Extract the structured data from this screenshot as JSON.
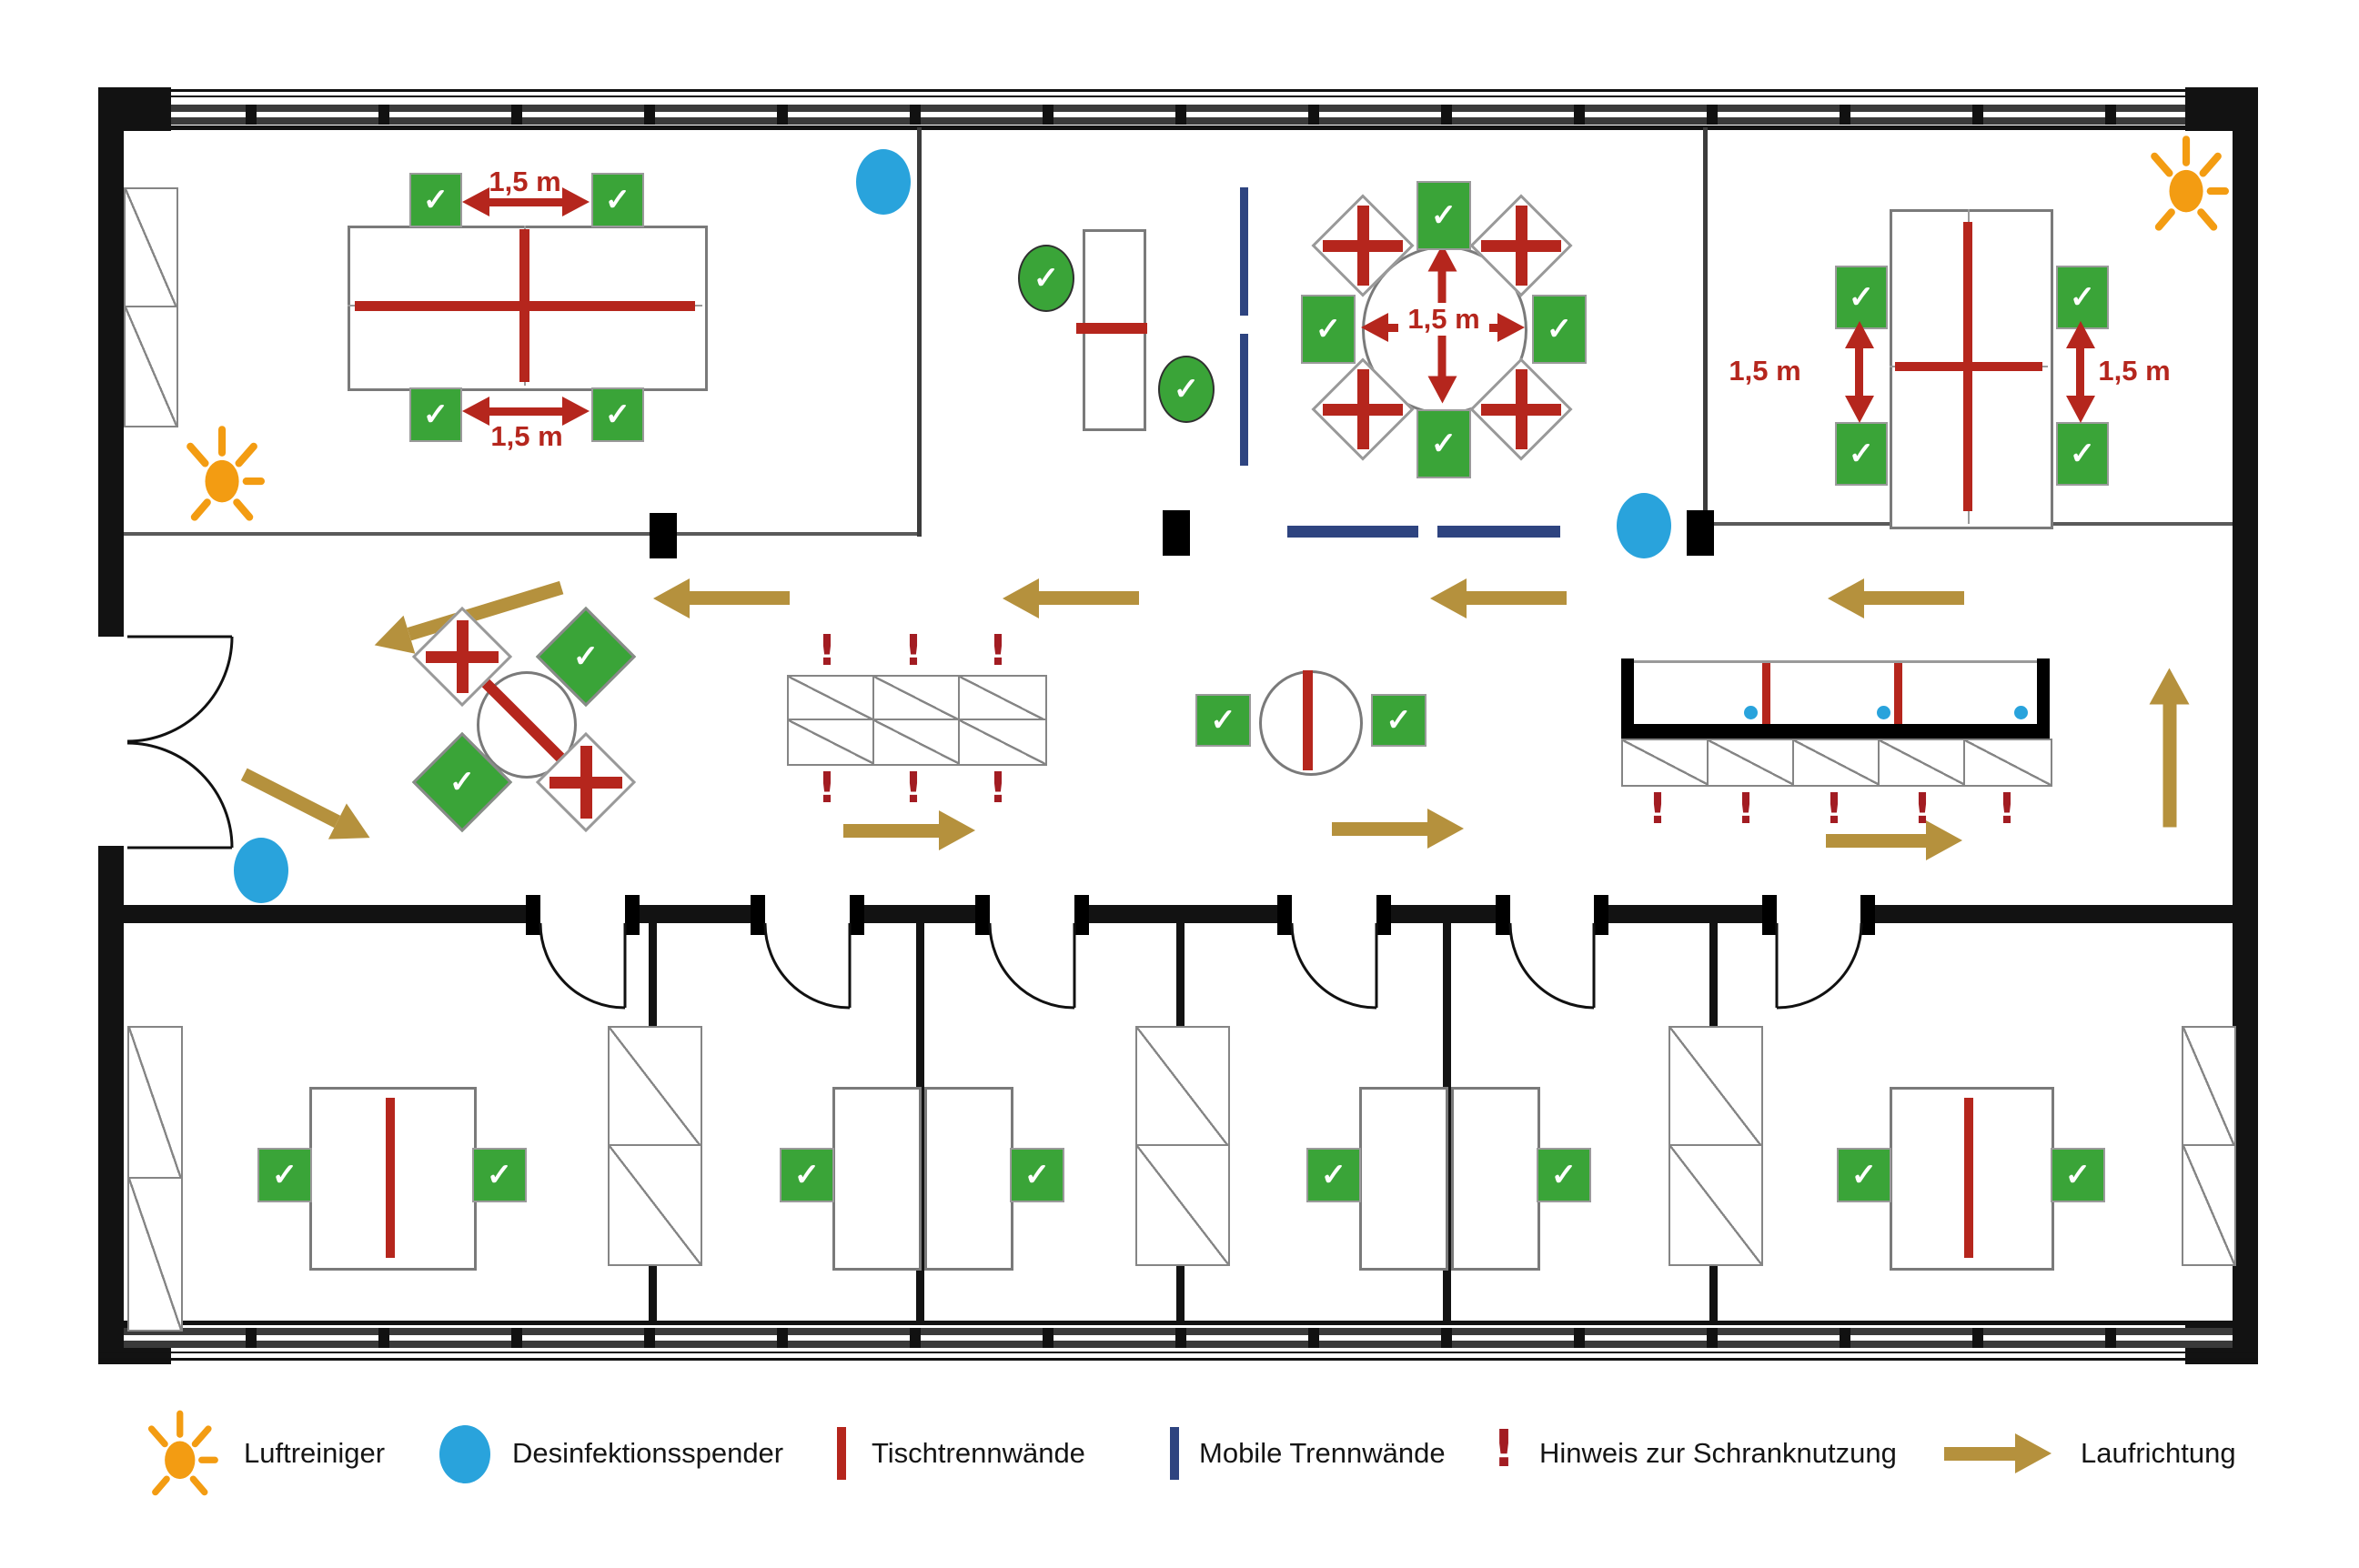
{
  "legend": {
    "items": [
      {
        "id": "air-purifier",
        "label": "Luftreiniger"
      },
      {
        "id": "disinfectant-dispenser",
        "label": "Desinfektionsspender"
      },
      {
        "id": "table-partition",
        "label": "Tischtrennwände"
      },
      {
        "id": "mobile-partition",
        "label": "Mobile Trennwände"
      },
      {
        "id": "cabinet-usage-notice",
        "label": "Hinweis zur Schranknutzung"
      },
      {
        "id": "walking-direction",
        "label": "Laufrichtung"
      }
    ]
  },
  "labels": {
    "distance": "1,5 m"
  },
  "glyphs": {
    "check": "✓",
    "exclamation": "!"
  },
  "colors": {
    "seat_allowed_green": "#3aa438",
    "partition_red": "#b5261d",
    "notice_red": "#a21c22",
    "dispenser_blue": "#29a3dc",
    "mobile_partition_navy": "#2e4480",
    "direction_tan": "#b5913d",
    "air_purifier_orange": "#f39c12",
    "wall_black": "#121212"
  }
}
